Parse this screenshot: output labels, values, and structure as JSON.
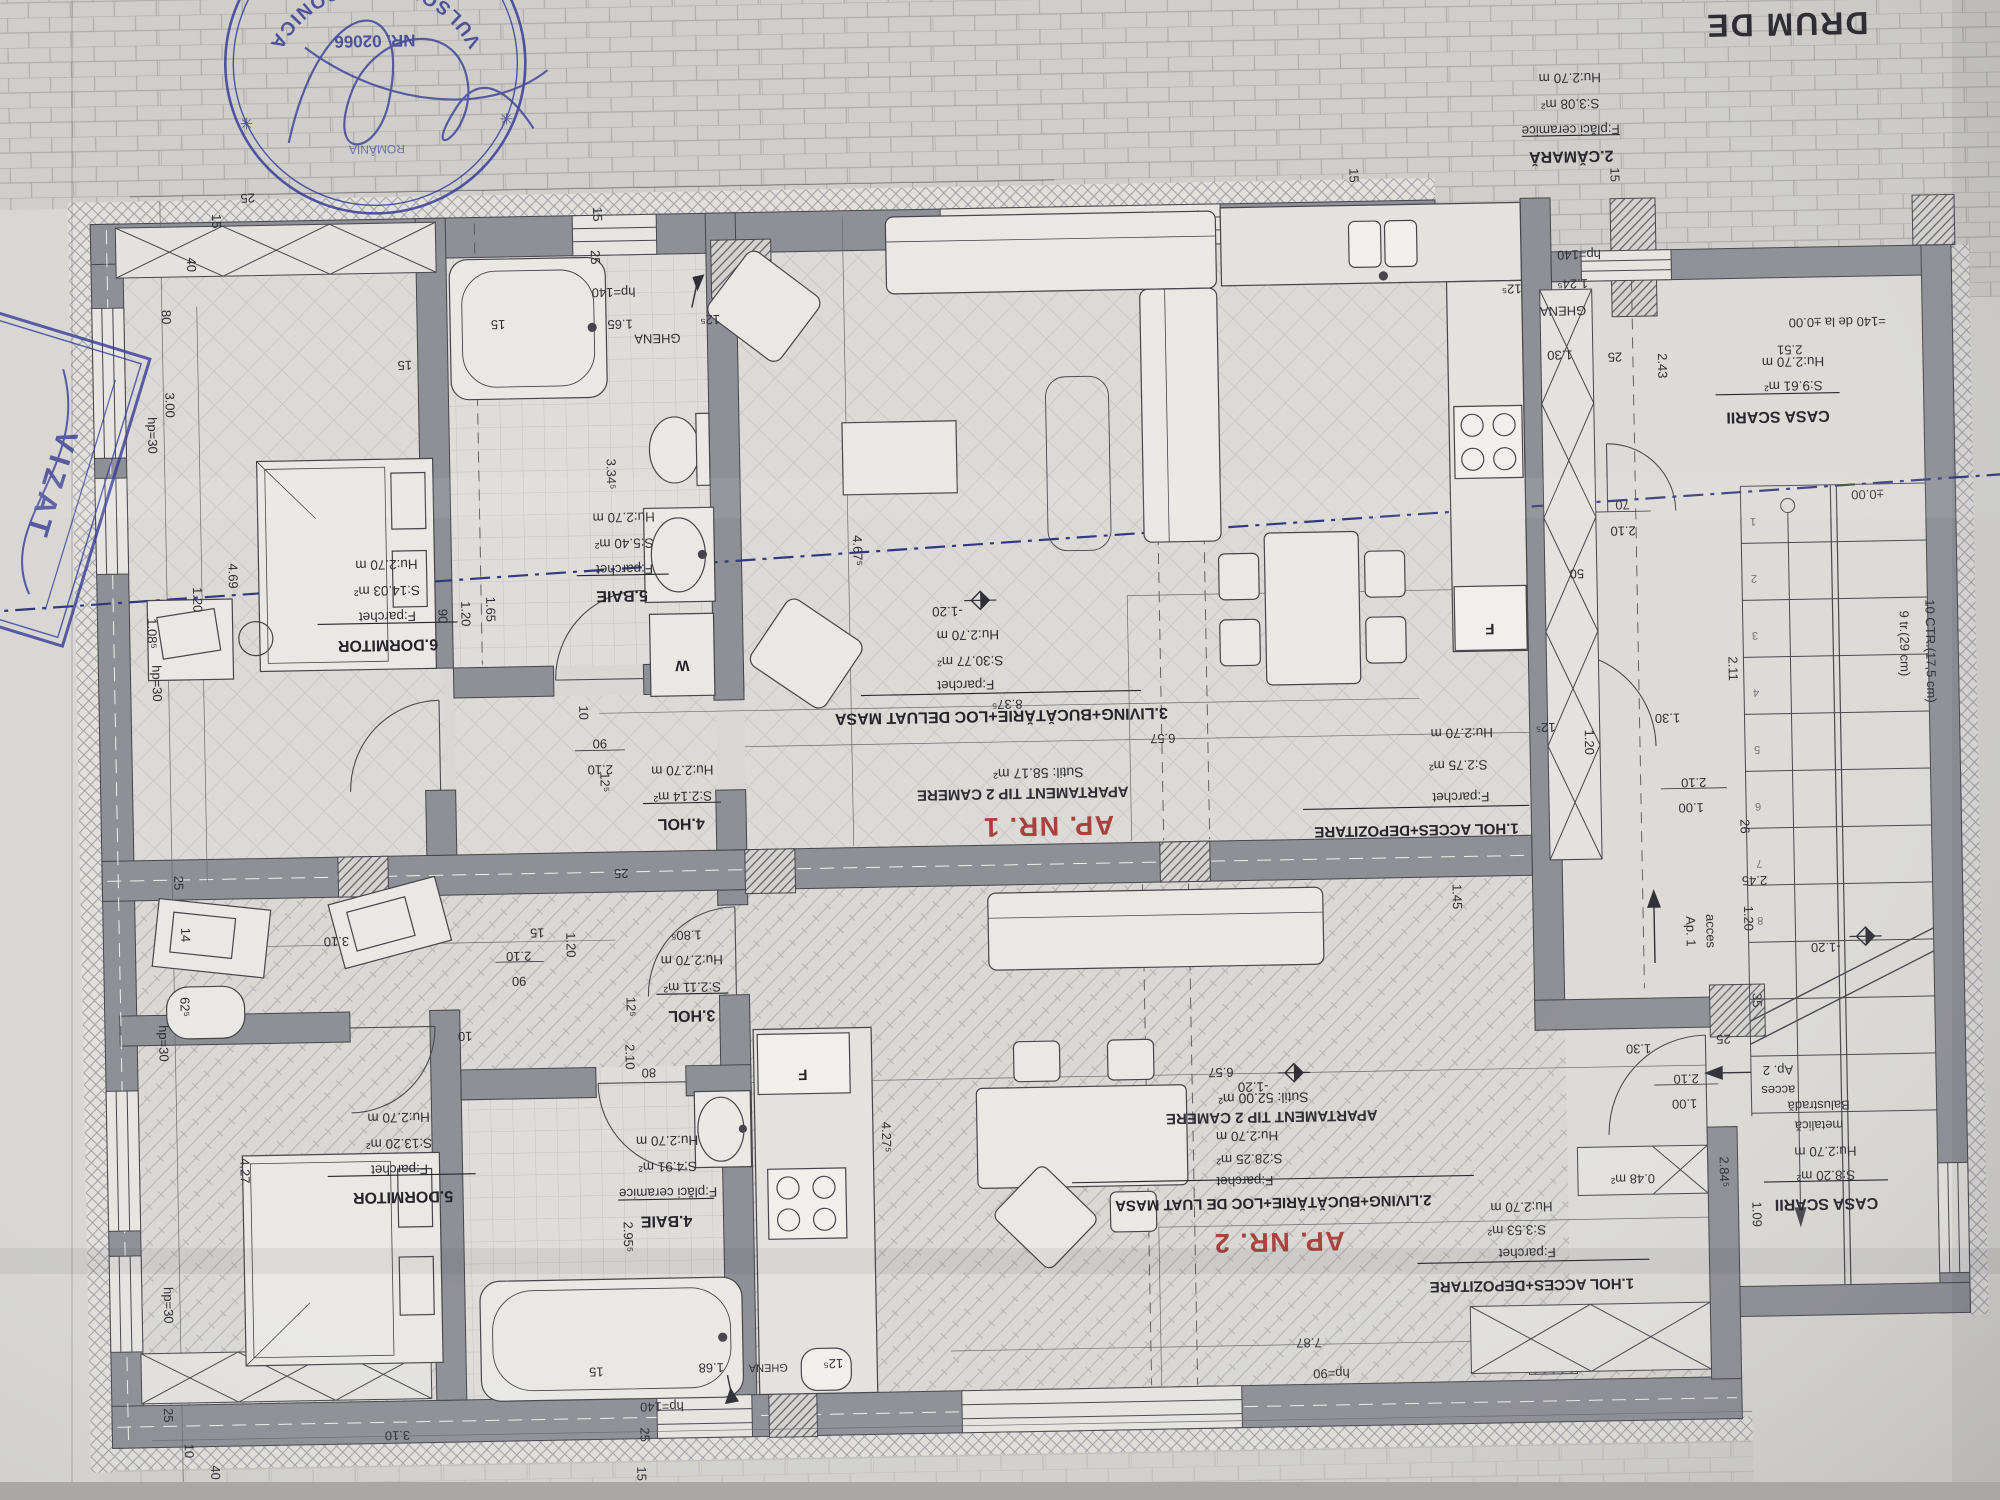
{
  "street": "DRUM DE",
  "ap1": {
    "label": "AP. NR. 1",
    "type": "APARTAMENT TIP 2 CAMERE",
    "suprafata": "Sutil: 58.17 m²",
    "hol1": {
      "name": "1.HOL ACCES+DEPOZITARE",
      "floor": "F:parchet",
      "area": "S:2.75 m²",
      "h": "Hu:2.70 m"
    },
    "camara": {
      "name": "2.CĂMARĂ",
      "floor": "F:plăci ceramice",
      "area": "S:3.08 m²",
      "h": "Hu:2.70 m"
    },
    "living": {
      "name": "3.LIVING+BUCĂTĂRIE+LOC DELUAT MASA",
      "floor": "F:parchet",
      "area": "S:30.77 m²",
      "h": "Hu:2.70 m"
    },
    "hol4": {
      "name": "4.HOL",
      "area": "S:2.14 m²",
      "h": "Hu:2.70 m"
    },
    "baie": {
      "name": "5.BAIE",
      "floor": "F:parchet",
      "area": "S:5.40 m²",
      "h": "Hu:2.70 m"
    },
    "dormitor": {
      "name": "6.DORMITOR",
      "floor": "F:parchet",
      "area": "S:14.03 m²",
      "h": "Hu:2.70 m"
    }
  },
  "ap2": {
    "label": "AP. NR. 2",
    "type": "APARTAMENT TIP 2 CAMERE",
    "suprafata": "Sutil: 52.00 m²",
    "hol1": {
      "name": "1.HOL ACCES+DEPOZITARE",
      "floor": "F:parchet",
      "area": "S:3.53 m²",
      "h": "Hu:2.70 m"
    },
    "living": {
      "name": "2.LIVING+BUCĂTĂRIE+LOC DE LUAT MASA",
      "floor": "F:parchet",
      "area": "S:28.25 m²",
      "h": "Hu:2.70 m"
    },
    "hol3": {
      "name": "3.HOL",
      "area": "S:2.11 m²",
      "h": "Hu:2.70 m"
    },
    "baie": {
      "name": "4.BAIE",
      "floor": "F:plăci ceramice",
      "area": "S:4.91 m²",
      "h": "Hu:2.70 m"
    },
    "dormitor": {
      "name": "5.DORMITOR",
      "floor": "F:parchet",
      "area": "S:13.20 m²",
      "h": "Hu:2.70 m"
    },
    "storage": "0.48 m²"
  },
  "common": {
    "casa_sus": {
      "name": "CASA SCARII",
      "area": "S:9.61 m²",
      "h": "Hu:2.70 m"
    },
    "casa_jos": {
      "name": "CASA SCARII",
      "area": "S:8.20 m²",
      "h": "Hu:2.70 m"
    },
    "ghena": "GHENA",
    "bal1": "Balustradă",
    "bal2": "metalică",
    "acces": "acces",
    "ap1_short": "Ap. 1",
    "ap2_short": "Ap. 2",
    "tr1": "9 tr.(29 cm)",
    "tr2": "10 CTR.(17,5 cm)",
    "lvl_ref": "=140 de la ±0.00",
    "lvl0": "±0.00",
    "lvlm": "-1.20",
    "w": "W",
    "f": "F"
  },
  "steps": [
    "1",
    "2",
    "3",
    "4",
    "5",
    "6",
    "7",
    "8"
  ],
  "dims": {
    "v10": "10",
    "v14": "14",
    "v15": "15",
    "v25": "25",
    "v26": "26",
    "v35": "35",
    "v40": "40",
    "v50": "50",
    "v70": "70",
    "v80": "80",
    "v90": "90",
    "v100": "1.00",
    "v109": "1.09",
    "v120": "1.20",
    "v125": "12⁵",
    "v130": "1.30",
    "v145": "1.45",
    "v165": "1.65",
    "v168": "1.68",
    "v210": "2.10",
    "v211": "2.11",
    "v243": "2.43",
    "v245": "2.45",
    "v251": "2.51",
    "v284": "2.84⁵",
    "v295": "2.95⁵",
    "v300": "3.00",
    "v310": "3.10",
    "v334": "3.34⁵",
    "v427": "4.27",
    "v4275": "4.27⁵",
    "v467": "4.67⁵",
    "v469": "4.69",
    "v625": "62⁵",
    "v657": "6.57",
    "v787": "7.87",
    "v837": "8.37⁵",
    "v1085": "1.08⁵",
    "v1245": "1.24⁵",
    "v1805": "1.80⁵",
    "hp30": "hp=30",
    "hp90": "hp=90",
    "hp140": "hp=140"
  },
  "stamps": {
    "round_name": "VULSON N. VERONICA",
    "round_country": "ROMÂNIA",
    "round_nr": "NR. 02066",
    "star": "✳",
    "viza": "VIZAT"
  }
}
